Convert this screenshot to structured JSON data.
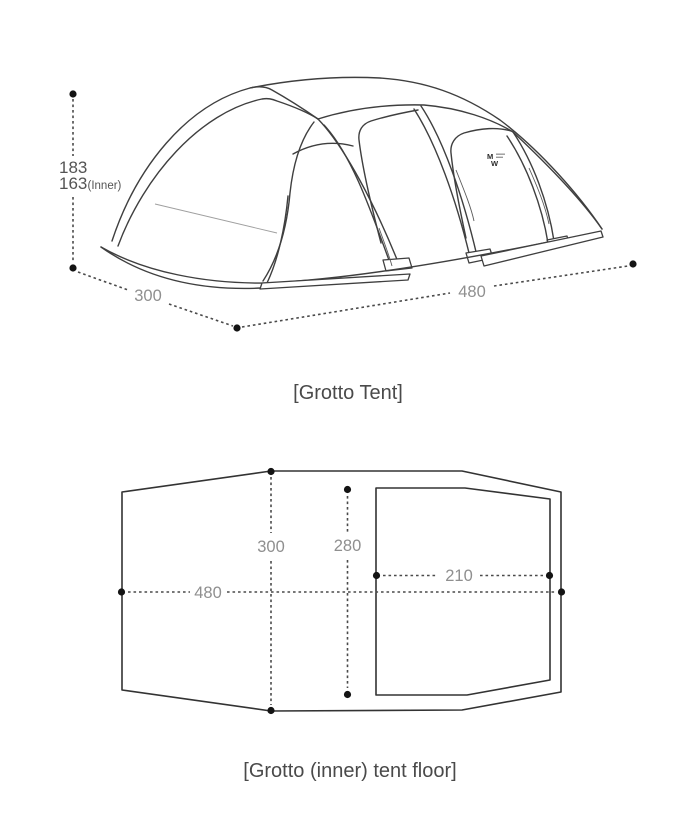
{
  "tent_diagram": {
    "caption": "[Grotto Tent]",
    "logo": {
      "top": "M",
      "bottom": "W"
    },
    "dimensions": {
      "height": "183",
      "inner_height": "163",
      "inner_height_suffix": "(Inner)",
      "depth": "300",
      "length": "480"
    }
  },
  "floor_diagram": {
    "caption": "[Grotto (inner) tent floor]",
    "dimensions": {
      "outer_width": "300",
      "inner_width": "280",
      "outer_length": "480",
      "inner_length": "210"
    }
  },
  "colors": {
    "line": "#3f3f3f",
    "dimension_line": "#4a4a4a",
    "dimension_text": "#8f8f8f",
    "height_text": "#545454",
    "caption_text": "#4a4a4a",
    "dot": "#141414",
    "background": "#ffffff"
  }
}
